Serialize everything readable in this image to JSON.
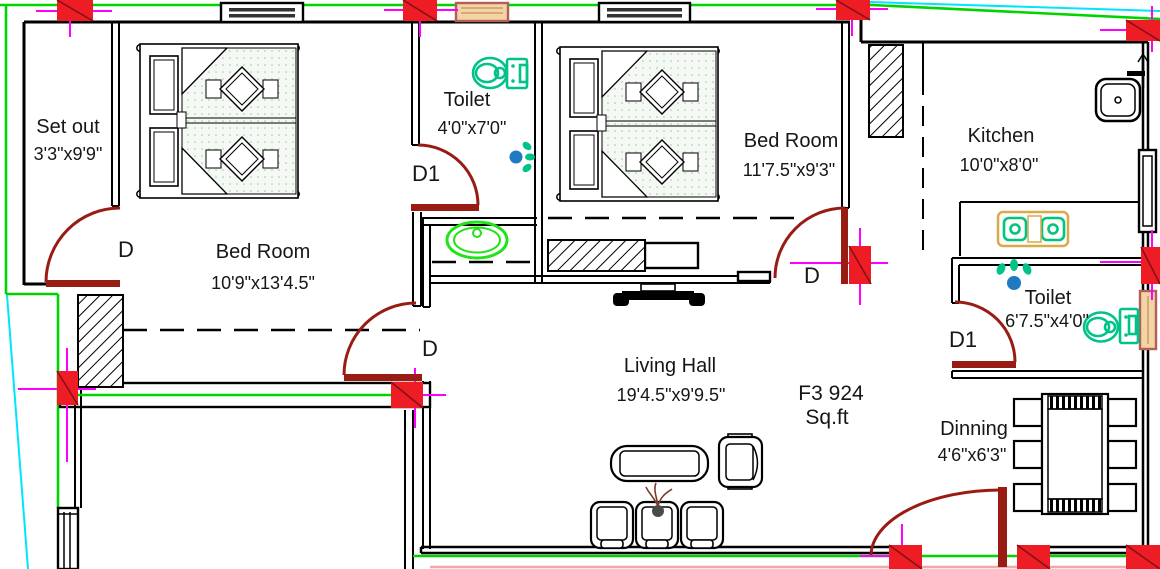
{
  "plan": {
    "unit_label": {
      "line1": "F3 924",
      "line2": "Sq.ft"
    },
    "rooms": [
      {
        "name": "Set out",
        "dims": "3'3\"x9'9\""
      },
      {
        "name": "Bed Room",
        "dims": "10'9\"x13'4.5\""
      },
      {
        "name": "Toilet",
        "dims": "4'0\"x7'0\""
      },
      {
        "name": "Bed Room",
        "dims": "11'7.5\"x9'3\""
      },
      {
        "name": "Kitchen",
        "dims": "10'0\"x8'0\""
      },
      {
        "name": "Toilet",
        "dims": "6'7.5\"x4'0\""
      },
      {
        "name": "Living Hall",
        "dims": "19'4.5\"x9'9.5\""
      },
      {
        "name": "Dinning",
        "dims": "4'6\"x6'3\""
      }
    ],
    "doors": {
      "setout_door": "D",
      "toilet1_door": "D1",
      "bedroom1_door": "D",
      "bedroom2_door": "D",
      "toilet2_door": "D1"
    },
    "colors": {
      "wall": "#000000",
      "door": "#981b14",
      "column": "#ee1c25",
      "centerline": "#ff00ff",
      "boundary_green": "#00d400",
      "boundary_cyan": "#00e5ff",
      "fixture_teal": "#00c389",
      "basin_green": "#21e418",
      "window_tan": "#f2d4a5",
      "water_blue": "#1f7ac2"
    }
  }
}
